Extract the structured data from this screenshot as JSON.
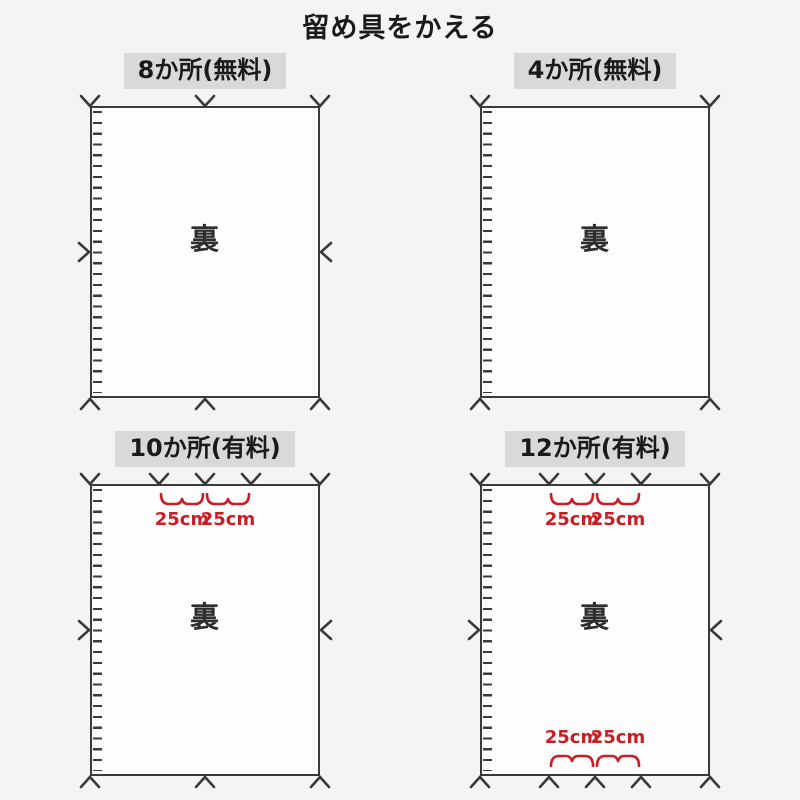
{
  "title": "留め具をかえる",
  "colors": {
    "page_bg": "#f4f4f3",
    "sheet_bg": "#fdfdfd",
    "line": "#3a3a3a",
    "header_bg": "#d9d9d9",
    "text": "#1a1a1a",
    "accent_red": "#c81e24"
  },
  "panels": [
    {
      "id": "8-places",
      "label": "8か所(無料)",
      "back_label": "裏",
      "marks": {
        "top": [
          0,
          50,
          100
        ],
        "right": [
          50
        ],
        "bottom": [
          0,
          50,
          100
        ],
        "left": [
          50
        ]
      },
      "braces_top": [],
      "braces_bottom": []
    },
    {
      "id": "4-places",
      "label": "4か所(無料)",
      "back_label": "裏",
      "marks": {
        "top": [
          0,
          100
        ],
        "right": [],
        "bottom": [
          0,
          100
        ],
        "left": []
      },
      "braces_top": [],
      "braces_bottom": []
    },
    {
      "id": "10-places",
      "label": "10か所(有料)",
      "back_label": "裏",
      "marks": {
        "top": [
          0,
          30,
          50,
          70,
          100
        ],
        "right": [
          50
        ],
        "bottom": [
          0,
          50,
          100
        ],
        "left": [
          50
        ]
      },
      "braces_top": [
        {
          "from": 30,
          "to": 50,
          "label": "25cm"
        },
        {
          "from": 50,
          "to": 70,
          "label": "25cm"
        }
      ],
      "braces_bottom": []
    },
    {
      "id": "12-places",
      "label": "12か所(有料)",
      "back_label": "裏",
      "marks": {
        "top": [
          0,
          30,
          50,
          70,
          100
        ],
        "right": [
          50
        ],
        "bottom": [
          0,
          30,
          50,
          70,
          100
        ],
        "left": [
          50
        ]
      },
      "braces_top": [
        {
          "from": 30,
          "to": 50,
          "label": "25cm"
        },
        {
          "from": 50,
          "to": 70,
          "label": "25cm"
        }
      ],
      "braces_bottom": [
        {
          "from": 30,
          "to": 50,
          "label": "25cm"
        },
        {
          "from": 50,
          "to": 70,
          "label": "25cm"
        }
      ]
    }
  ]
}
